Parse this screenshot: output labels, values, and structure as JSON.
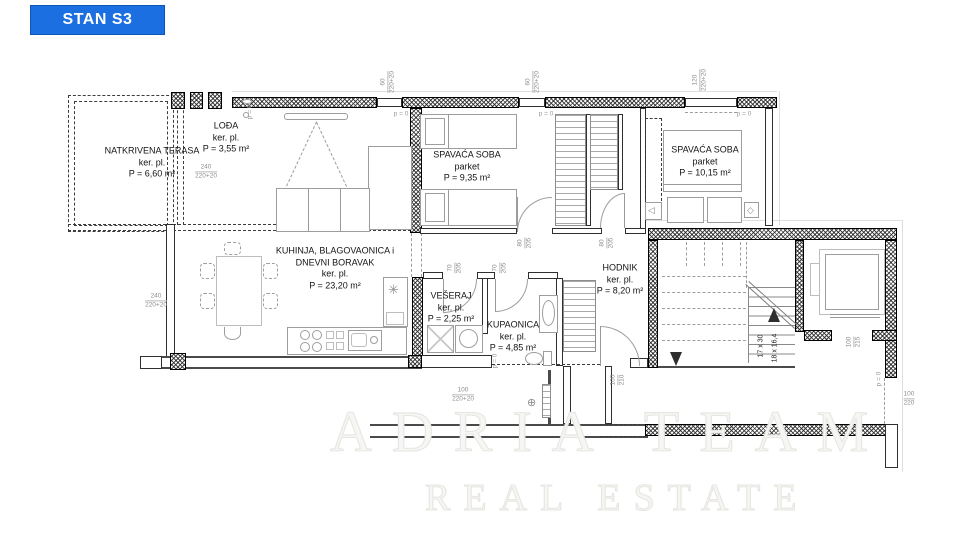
{
  "badge": {
    "label": "STAN S3",
    "bg": "#1c6fe0",
    "border": "#0f55b8",
    "text_color": "#ffffff"
  },
  "watermark": {
    "line1": "ADRIA TEAM",
    "line2": "REAL ESTATE"
  },
  "rooms": [
    {
      "id": "natkrivena-terasa",
      "x": 152,
      "y": 163,
      "lines": [
        "NATKRIVENA TERASA",
        "ker. pl.",
        "P = 6,60 m²"
      ]
    },
    {
      "id": "lodja",
      "x": 226,
      "y": 138,
      "lines": [
        "LOĐA",
        "ker. pl.",
        "P = 3,55 m²"
      ]
    },
    {
      "id": "spavaca-soba-1",
      "x": 467,
      "y": 167,
      "lines": [
        "SPAVAĆA SOBA",
        "parket",
        "P = 9,35 m²"
      ]
    },
    {
      "id": "spavaca-soba-2",
      "x": 705,
      "y": 162,
      "lines": [
        "SPAVAĆA SOBA",
        "parket",
        "P = 10,15 m²"
      ]
    },
    {
      "id": "kuhinja",
      "x": 335,
      "y": 269,
      "lines": [
        "KUHINJA, BLAGOVAONICA i",
        "DNEVNI BORAVAK",
        "ker. pl.",
        "P = 23,20 m²"
      ]
    },
    {
      "id": "veseraj",
      "x": 451,
      "y": 308,
      "lines": [
        "VEŠERAJ",
        "ker. pl.",
        "P = 2,25 m²"
      ]
    },
    {
      "id": "kupaonica",
      "x": 513,
      "y": 337,
      "lines": [
        "KUPAONICA",
        "ker. pl.",
        "P = 4,85 m²"
      ]
    },
    {
      "id": "hodnik",
      "x": 620,
      "y": 280,
      "lines": [
        "HODNIK",
        "ker. pl.",
        "P = 8,20 m²"
      ]
    }
  ],
  "stairs": {
    "label1": "17 x 30",
    "label2": "18 x 16,4"
  },
  "dims": [
    {
      "x": 388,
      "y": 82,
      "rot": true,
      "lines": [
        "60",
        "220+20"
      ]
    },
    {
      "x": 533,
      "y": 82,
      "rot": true,
      "lines": [
        "60",
        "220+20"
      ]
    },
    {
      "x": 700,
      "y": 80,
      "rot": true,
      "lines": [
        "120",
        "220+20"
      ]
    },
    {
      "x": 156,
      "y": 301,
      "rot": false,
      "lines": [
        "240",
        "220+20"
      ]
    },
    {
      "x": 206,
      "y": 172,
      "rot": false,
      "lines": [
        "240",
        "220+20"
      ]
    },
    {
      "x": 525,
      "y": 243,
      "rot": true,
      "lines": [
        "80",
        "205"
      ]
    },
    {
      "x": 607,
      "y": 243,
      "rot": true,
      "lines": [
        "80",
        "205"
      ]
    },
    {
      "x": 455,
      "y": 268,
      "rot": true,
      "lines": [
        "70",
        "205"
      ]
    },
    {
      "x": 500,
      "y": 268,
      "rot": true,
      "lines": [
        "70",
        "205"
      ]
    },
    {
      "x": 618,
      "y": 380,
      "rot": true,
      "lines": [
        "100",
        "210"
      ]
    },
    {
      "x": 463,
      "y": 395,
      "rot": false,
      "lines": [
        "100",
        "220+20"
      ]
    },
    {
      "x": 854,
      "y": 342,
      "rot": true,
      "lines": [
        "100",
        "215"
      ]
    },
    {
      "x": 909,
      "y": 399,
      "rot": false,
      "lines": [
        "100",
        "220"
      ]
    }
  ],
  "p0": {
    "label": "p = 0",
    "items": [
      {
        "x": 401,
        "y": 114,
        "rot": false
      },
      {
        "x": 546,
        "y": 114,
        "rot": false
      },
      {
        "x": 744,
        "y": 114,
        "rot": false
      },
      {
        "x": 250,
        "y": 112,
        "rot": true
      },
      {
        "x": 495,
        "y": 361,
        "rot": true
      },
      {
        "x": 879,
        "y": 379,
        "rot": true
      }
    ]
  },
  "icons": {
    "boiler": "✳",
    "valve": "⊕",
    "arrow_left": "◁",
    "diamond": "◇"
  },
  "colors": {
    "accent_blue": "#1c6fe0",
    "wall": "#000000",
    "dim_text": "#8d8d8d",
    "room_text": "#141414"
  }
}
